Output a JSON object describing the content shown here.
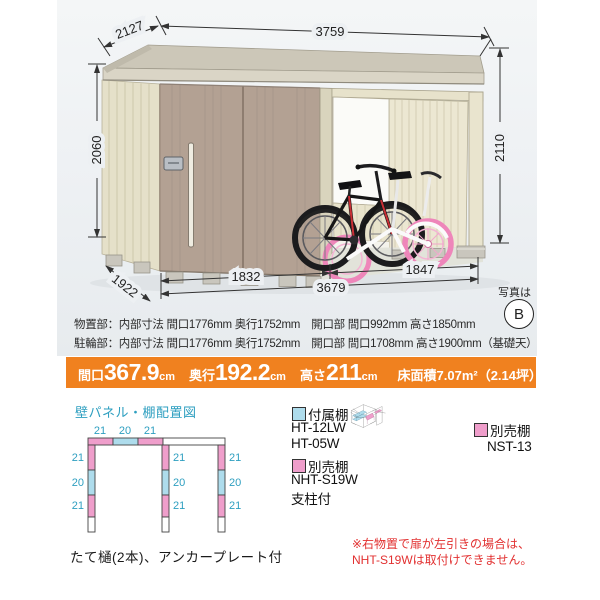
{
  "photo": {
    "dims": {
      "depth_top": "2127",
      "width_top": "3759",
      "height_left": "2060",
      "height_right": "2110",
      "depth_bottom": "1922",
      "width_storage": "1832",
      "width_bike": "1847",
      "width_total": "3679"
    },
    "photo_ref": {
      "label": "写真は",
      "letter": "B"
    },
    "specs": [
      "物置部：内部寸法 間口1776mm 奥行1752mm　開口部 間口992mm 高さ1850mm",
      "駐輪部：内部寸法 間口1776mm 奥行1752mm　開口部 間口1708mm 高さ1900mm（基礎天）"
    ]
  },
  "size_bar": {
    "bg_color": "#f0811f",
    "items": [
      {
        "label": "間口",
        "value": "367.9",
        "unit": "cm"
      },
      {
        "label": "奥行",
        "value": "192.2",
        "unit": "cm"
      },
      {
        "label": "高さ",
        "value": "211",
        "unit": "cm"
      }
    ],
    "area_label": "床面積",
    "area_value": "7.07m²（2.14坪）"
  },
  "plan": {
    "title": "壁パネル・棚配置図",
    "accent_color": "#2e9fc0",
    "panel_pink": "#ef9ecb",
    "panel_cyan": "#aedcec",
    "top_labels": [
      "21",
      "20",
      "21"
    ],
    "left_labels": [
      "21",
      "20",
      "21"
    ],
    "middle_labels": [
      "21",
      "20",
      "21"
    ],
    "right_labels": [
      "21",
      "20",
      "21"
    ]
  },
  "legend": {
    "attached": {
      "swatch_color": "#aedcec",
      "label": "付属棚",
      "models": [
        "HT-12LW",
        "HT-05W"
      ]
    },
    "optional_left": {
      "swatch_color": "#ef9ecb",
      "label": "別売棚",
      "models": [
        "NHT-S19W",
        "支柱付"
      ]
    },
    "optional_right": {
      "swatch_color": "#ef9ecb",
      "label": "別売棚",
      "model": "NST-13"
    }
  },
  "notes": {
    "eaves": "たて樋(2本)、アンカープレート付",
    "warning_lines": [
      "※右物置で扉が左引きの場合は、",
      "NHT-S19Wは取付けできません。"
    ]
  }
}
